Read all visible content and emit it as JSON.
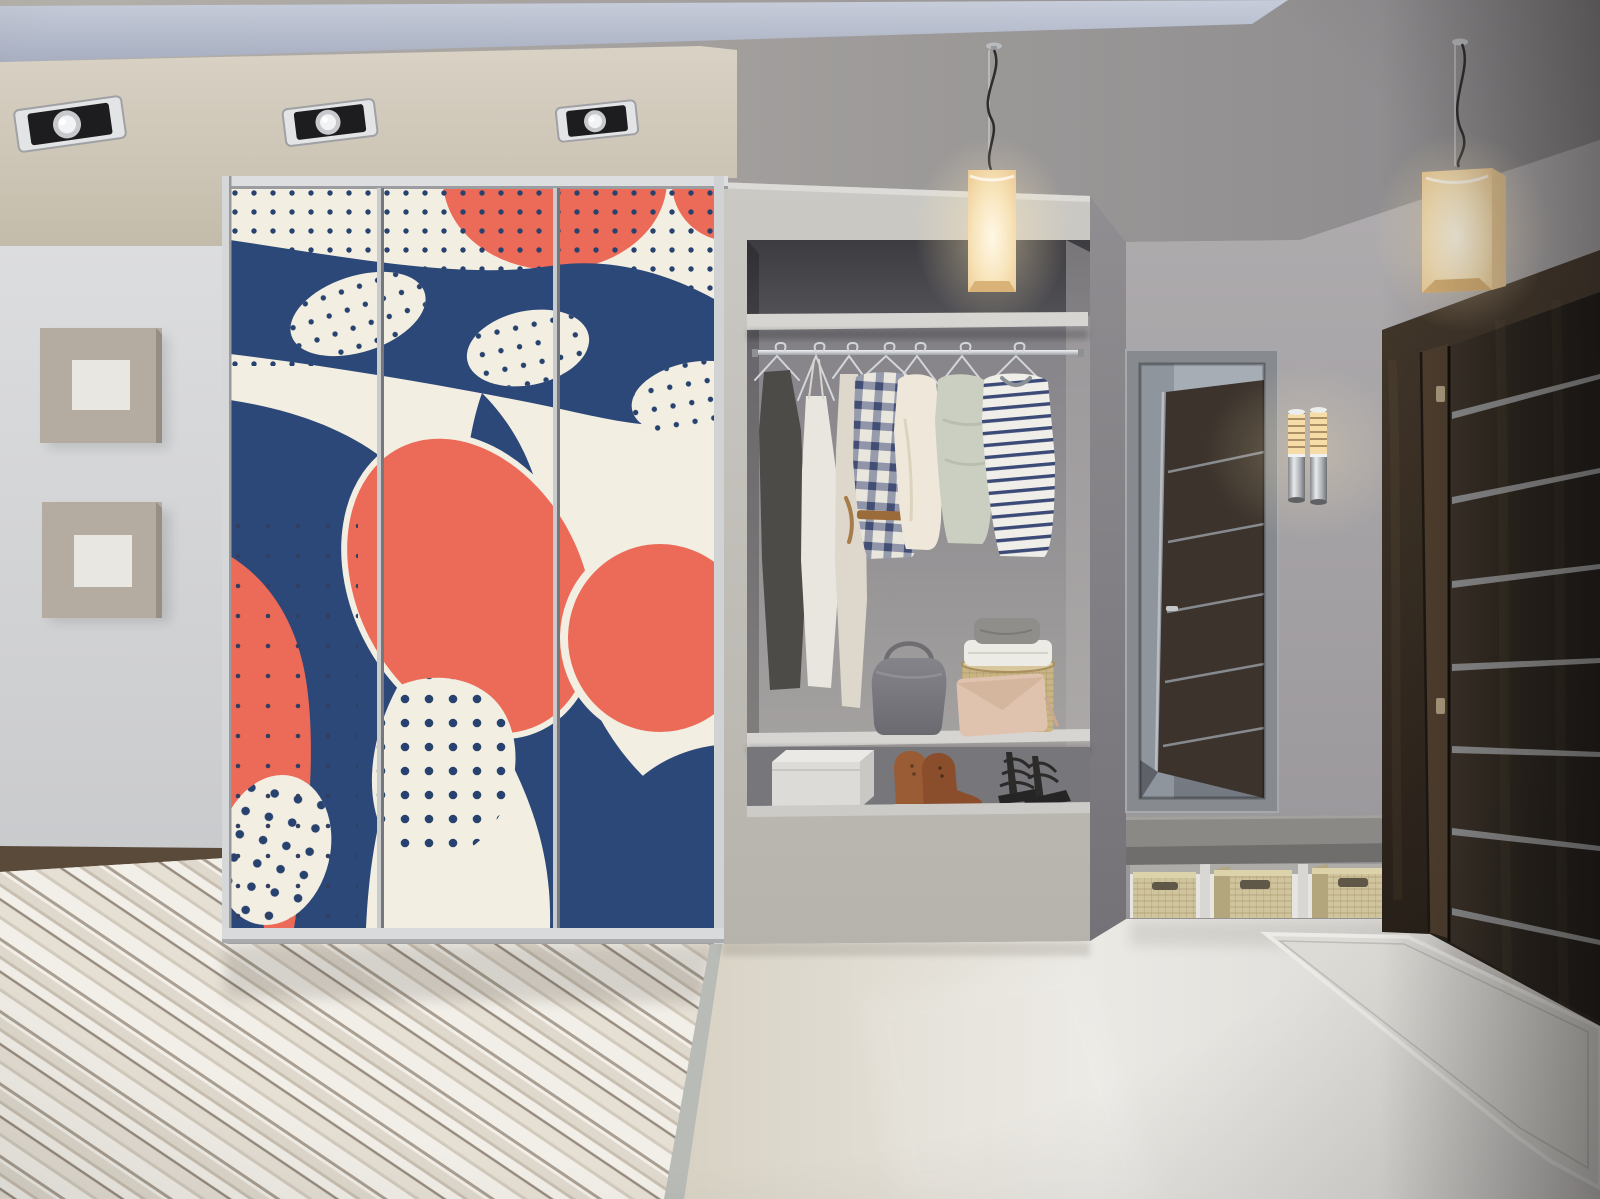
{
  "image": {
    "width": 1600,
    "height": 1199,
    "kind": "photoreal interior render",
    "description": "Modern hallway entry: three-door sliding wardrobe with abstract navy/coral art, open closet niche with clothes and shoes, cube pendant lamps, mirror reflecting a dark wenge door, wall sconce, dark entry door, bench with wicker baskets, wood plank and glossy tile floors"
  },
  "palette": {
    "cream": "#f2eee1",
    "navy": "#2c4878",
    "navy_deep": "#27426f",
    "coral": "#ec6a58",
    "soffit_light": "#d9d2c5",
    "soffit_dark": "#c3bba9",
    "band_light": "#c7cdda",
    "band_dark": "#a7aec0",
    "ceiling_left": "#b5b1ab",
    "ceiling_right": "#8a888b",
    "wall_left_top": "#dcddde",
    "wall_left_bottom": "#bfc0c3",
    "wall_right_top": "#b0adaf",
    "wall_right_bottom": "#918e93",
    "fascia_top": "#cbc9c4",
    "fascia_bottom": "#b6b3ac",
    "niche_top": "#515055",
    "niche_mid": "#87858a",
    "niche_bottom": "#a9a6a4",
    "shelf": "#d6d5d2",
    "plank_light": "#f1eee7",
    "plank_mid": "#e3ddd1",
    "plank_shadow": "#a3988a",
    "tile_left": "#d8d2c4",
    "tile_mid": "#ebe9e4",
    "tile_right": "#d6d4d1",
    "rug": "#dcdbd6",
    "door_wood_light": "#44382b",
    "door_wood_dark": "#241d16",
    "door_strip": "#8d8e8f",
    "lamp_core": "#fff8e6",
    "lamp_edge": "#ecc891",
    "glow": "#ffe9b9",
    "mirror_top": "#9aa1ab",
    "mirror_bottom": "#747981",
    "mirror_frame": "#878a8f",
    "bench_top": "#8b8986",
    "bench_front": "#6f6e6c",
    "wicker": "#cfc49c",
    "wicker_side": "#b3a67d",
    "art_outer": "#b4aca1",
    "art_inner": "#e9e7e2",
    "bag_gray": "#7b7a7f",
    "clutch_blush": "#e0c3ae",
    "basket_tan": "#c9b584",
    "boot_brown": "#9a5c34",
    "sandal_black": "#2c2b2a",
    "garment_charcoal": "#4c4b48",
    "garment_white": "#e9e6df",
    "garment_robe": "#ded8cc",
    "garment_cream": "#efe8da",
    "garment_sage": "#cbcfc1",
    "chrome_light": "#f0f1f3",
    "chrome_dark": "#9fa3a8"
  },
  "scene": {
    "ceiling": {
      "recessed_spotlights": 3,
      "recessed_cove_band": true,
      "cream_soffit": true
    },
    "pendant_lamps": {
      "count": 2,
      "shade": "frosted glass cube, warm glow",
      "cord": "black wavy cable"
    },
    "wardrobe": {
      "sliding_doors": 3,
      "frame": "brushed aluminium",
      "art_style": "abstract blobs and waves with polka dots",
      "art_colors": [
        "cream",
        "navy",
        "coral"
      ]
    },
    "closet_niche": {
      "top_shelf": true,
      "hanging_rod": "chrome",
      "garments": [
        "charcoal apron dress",
        "white slip dress",
        "long cream robe",
        "navy plaid shirt",
        "cream long-sleeve top",
        "sage knit sweater",
        "navy striped tee"
      ],
      "shelf_items": [
        "gray leather handbag",
        "blush envelope clutch",
        "round wicker basket",
        "folded white towels",
        "folded gray sweater"
      ],
      "shoe_area_items": [
        "white shoe box",
        "brown leather boots",
        "black strappy heels"
      ]
    },
    "left_wall": {
      "art_panels": 2,
      "panel_style": "square within square relief"
    },
    "mirror": {
      "frame": "gray",
      "reflection": "dark wenge door with metal strips"
    },
    "wall_sconce": {
      "tubes": 2,
      "finish": "chrome with glowing slatted tops"
    },
    "entry_door": {
      "material": "dark wenge wood",
      "metal_strips": 7,
      "hinges": 2
    },
    "bench": {
      "seat": "gray stone slab",
      "wicker_baskets": 3
    },
    "floor": {
      "left": "diagonal whitewashed wood planks",
      "right": "glossy beige tile",
      "rug": "light gray mat by the door",
      "dark_border_strip": true
    }
  }
}
